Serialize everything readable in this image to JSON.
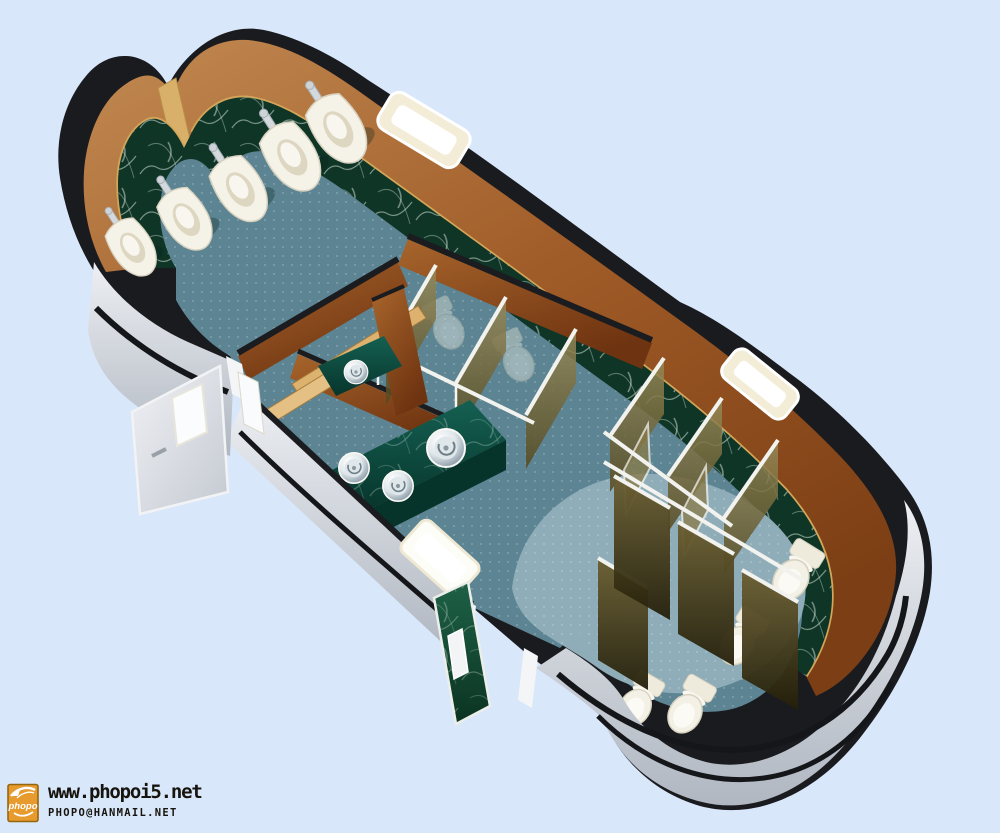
{
  "watermark": {
    "site_url": "www.phopoi5.net",
    "email": "phopo@hanmail.net",
    "logo_text": "phopo"
  },
  "scene": {
    "subject": "3d-cutaway-public-restroom-render",
    "urinals_visible": 5,
    "toilets_visible": 4,
    "sinks_visible": 4,
    "windows_visible": 3,
    "doors_open": 2
  },
  "colors": {
    "background": "#d9e7fb",
    "rim_black": "#1a1b1f",
    "wood_wall": "#a8672f",
    "marble_green": "#0f3527",
    "gold_trim": "#d3a659",
    "carpet_teal": "#5c8492",
    "carpet_light": "#8fadb9",
    "exterior_gray": "#c9ced6",
    "counter_green": "#0b4a3e",
    "partition_olive": "#6b603a",
    "fixture_white": "#f4f1e6",
    "logo_orange": "#e79b2f"
  }
}
